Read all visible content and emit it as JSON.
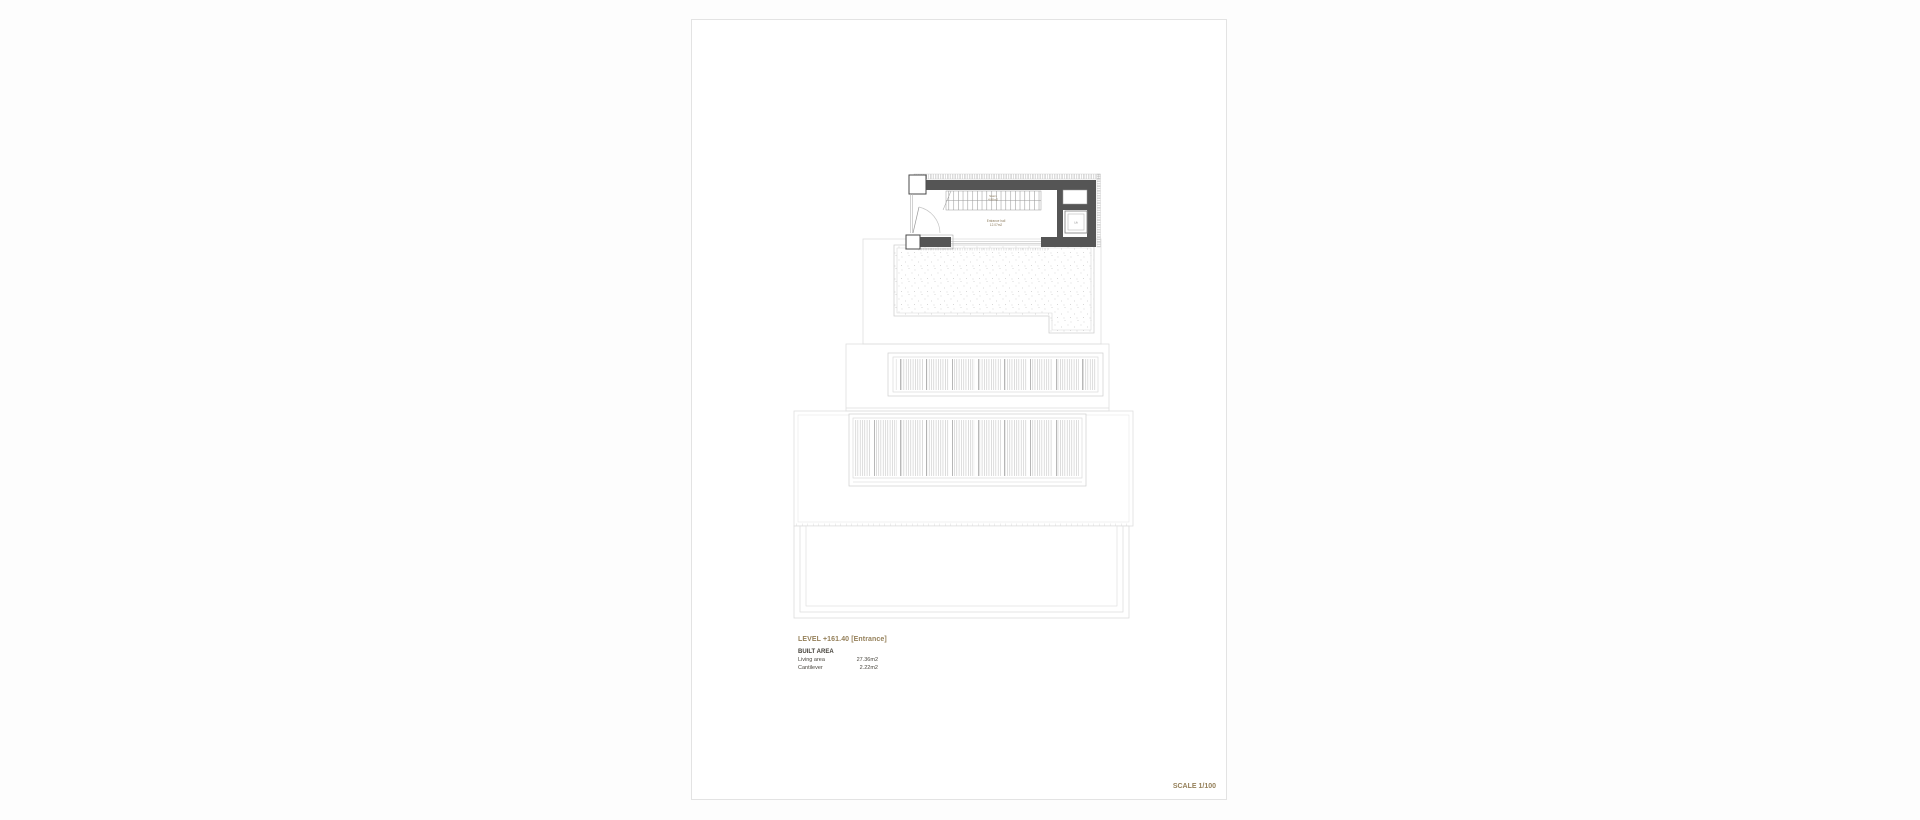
{
  "page": {
    "level_title": "LEVEL +161.40 [Entrance]",
    "scale_label": "SCALE 1/100"
  },
  "area_table": {
    "heading": "BUILT AREA",
    "rows": [
      {
        "label": "Living area",
        "value": "27.36m2"
      },
      {
        "label": "Cantilever",
        "value": "2.22m2"
      }
    ]
  },
  "plan": {
    "rooms": {
      "stairs": {
        "name": "Stairs",
        "area": "4.88m2"
      },
      "hall": {
        "name": "Entrance hall",
        "area": "12.07m2"
      },
      "lift": {
        "name": "Lift"
      }
    }
  },
  "colors": {
    "accent_olive": "#95805a",
    "wall_dark": "#555555",
    "outline_light": "#dedede"
  }
}
